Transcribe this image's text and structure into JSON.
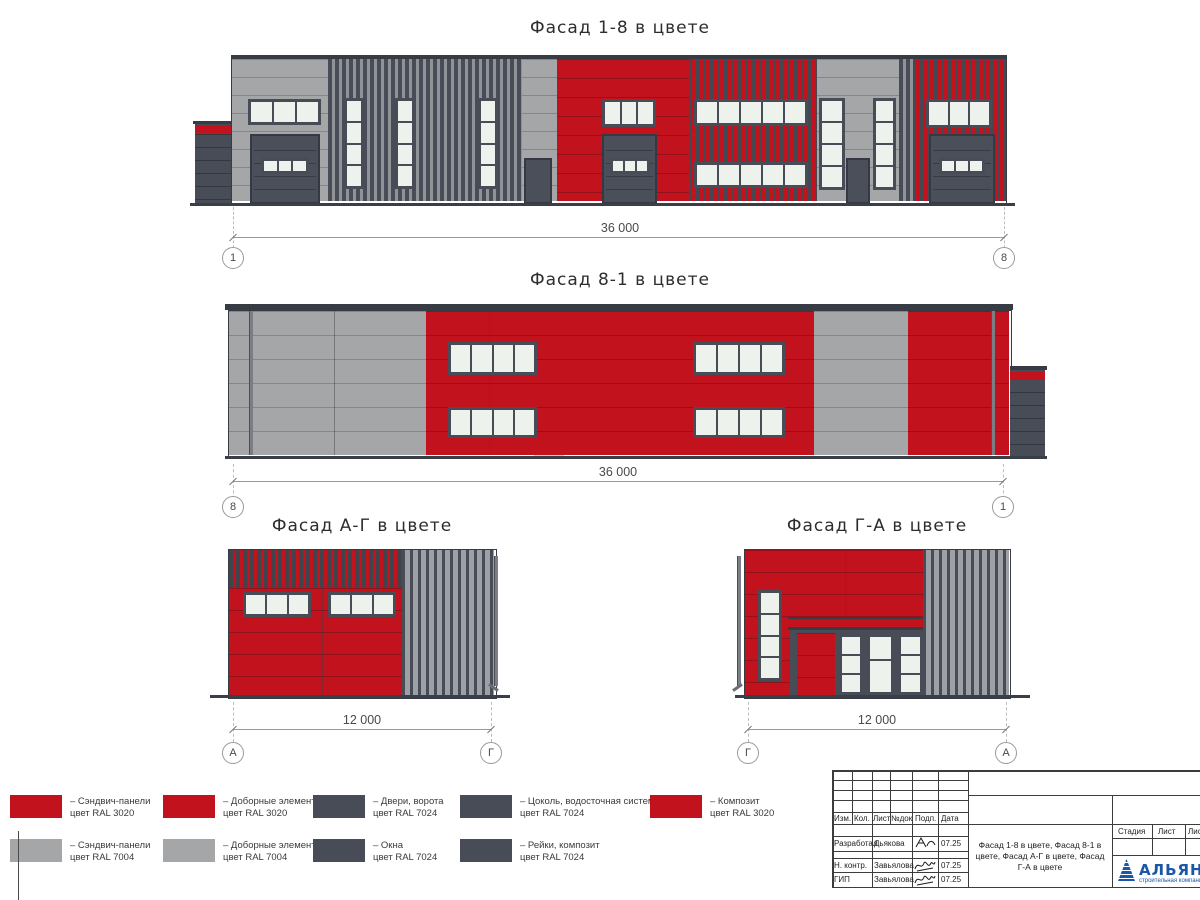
{
  "colors": {
    "ral_3020_red": "#c1121e",
    "ral_7004_gray": "#a5a6a8",
    "ral_7024_dark": "#474c56",
    "window_glass": "#eef2ed",
    "logo_blue": "#1b57a8"
  },
  "facades": [
    {
      "title": "Фасад 1-8 в цвете",
      "dimension": "36 000",
      "axis_left": "1",
      "axis_right": "8"
    },
    {
      "title": "Фасад 8-1 в цвете",
      "dimension": "36 000",
      "axis_left": "8",
      "axis_right": "1"
    },
    {
      "title": "Фасад А-Г в цвете",
      "dimension": "12 000",
      "axis_left": "А",
      "axis_right": "Г"
    },
    {
      "title": "Фасад Г-А в цвете",
      "dimension": "12 000",
      "axis_left": "Г",
      "axis_right": "А"
    }
  ],
  "legend": [
    {
      "color": "#c1121e",
      "line1": "– Сэндвич-панели",
      "line2": "цвет RAL 3020"
    },
    {
      "color": "#c1121e",
      "line1": "– Доборные элементы",
      "line2": "цвет RAL 3020"
    },
    {
      "color": "#474c56",
      "line1": "– Двери, ворота",
      "line2": "цвет RAL 7024"
    },
    {
      "color": "#474c56",
      "line1": "– Цоколь, водосточная система",
      "line2": "цвет RAL 7024"
    },
    {
      "color": "#c1121e",
      "line1": "– Композит",
      "line2": "цвет RAL 3020"
    },
    {
      "color": "#a5a6a8",
      "line1": "– Сэндвич-панели",
      "line2": "цвет RAL 7004"
    },
    {
      "color": "#a5a6a8",
      "line1": "– Доборные элементы",
      "line2": "цвет RAL 7004"
    },
    {
      "color": "#474c56",
      "line1": "– Окна",
      "line2": "цвет RAL 7024"
    },
    {
      "color": "#474c56",
      "line1": "– Рейки, композит",
      "line2": "цвет RAL 7024"
    }
  ],
  "watermark": {
    "text": "АЛЬЯНС"
  },
  "titleblock": {
    "revision_header": [
      "Изм.",
      "Кол.",
      "Лист",
      "№док",
      "Подп.",
      "Дата"
    ],
    "signature_rows": [
      {
        "role": "Разработал",
        "name": "Дьякова",
        "date": "07.25"
      },
      {
        "role": "Н. контр.",
        "name": "Завьялова",
        "date": "07.25"
      },
      {
        "role": "ГИП",
        "name": "Завьялова",
        "date": "07.25"
      }
    ],
    "description": "Фасад 1-8 в цвете, Фасад 8-1 в цвете, Фасад А-Г в цвете, Фасад Г-А в цвете",
    "stage_header": [
      "Стадия",
      "Лист",
      "Листов"
    ],
    "company": "АЛЬЯНС",
    "tagline": "строительная компания"
  }
}
